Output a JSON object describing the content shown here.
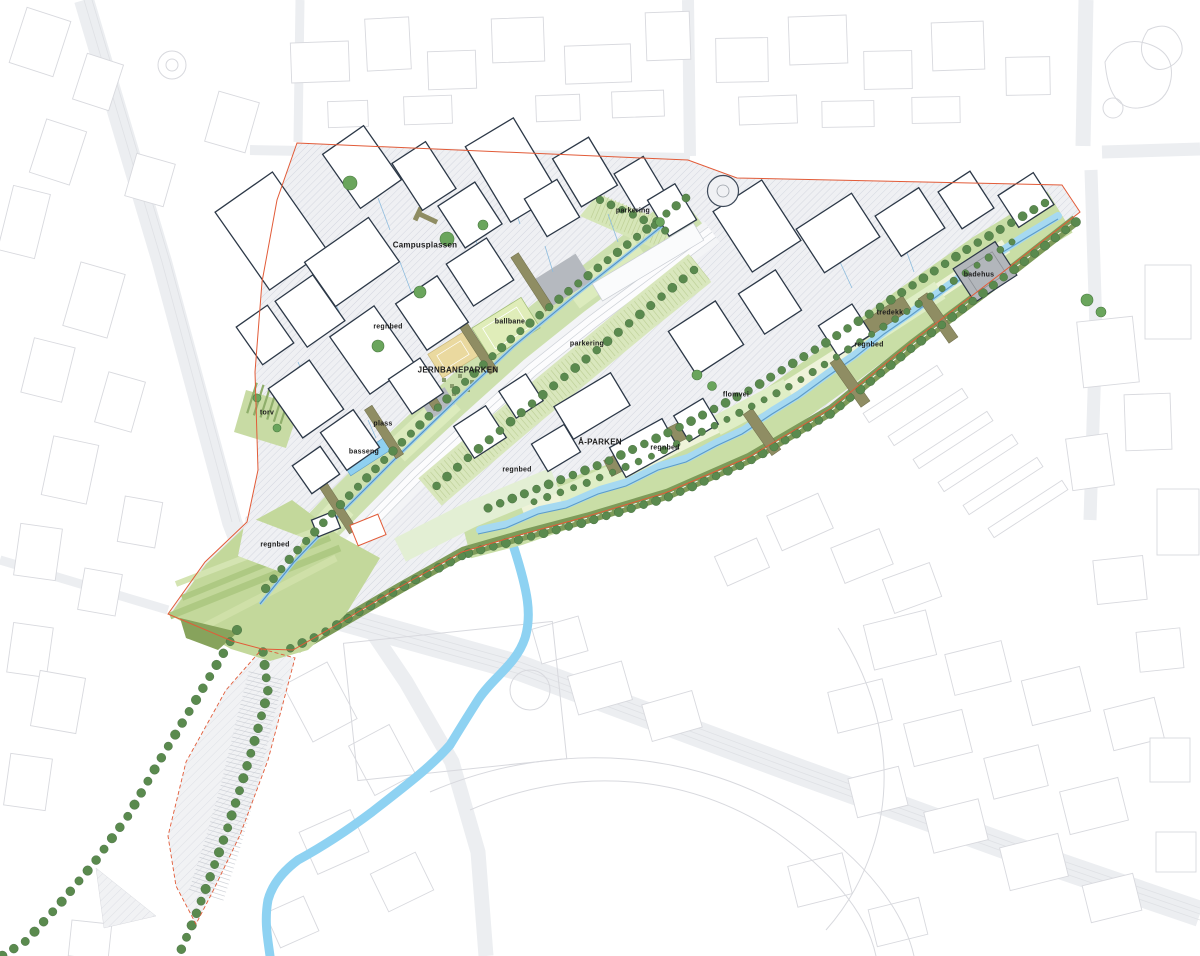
{
  "map": {
    "labels": [
      {
        "text": "Campusplassen",
        "x": 425,
        "y": 245,
        "size": 8
      },
      {
        "text": "parkering",
        "x": 633,
        "y": 211,
        "size": 7
      },
      {
        "text": "regnbed",
        "x": 388,
        "y": 327,
        "size": 7
      },
      {
        "text": "ballbane",
        "x": 510,
        "y": 322,
        "size": 7
      },
      {
        "text": "JERNBANEPARKEN",
        "x": 458,
        "y": 370,
        "size": 8
      },
      {
        "text": "parkering",
        "x": 587,
        "y": 344,
        "size": 7
      },
      {
        "text": "torv",
        "x": 267,
        "y": 413,
        "size": 7
      },
      {
        "text": "plass",
        "x": 383,
        "y": 424,
        "size": 7
      },
      {
        "text": "basseng",
        "x": 364,
        "y": 452,
        "size": 7
      },
      {
        "text": "Å-PARKEN",
        "x": 600,
        "y": 442,
        "size": 8
      },
      {
        "text": "regnbed",
        "x": 665,
        "y": 448,
        "size": 7
      },
      {
        "text": "flomvei",
        "x": 736,
        "y": 395,
        "size": 7
      },
      {
        "text": "tredekk",
        "x": 890,
        "y": 313,
        "size": 7
      },
      {
        "text": "regnbed",
        "x": 869,
        "y": 345,
        "size": 7
      },
      {
        "text": "badehus",
        "x": 979,
        "y": 275,
        "size": 7
      },
      {
        "text": "regnbed",
        "x": 517,
        "y": 470,
        "size": 7
      },
      {
        "text": "regnbed",
        "x": 275,
        "y": 545,
        "size": 7
      }
    ]
  },
  "palette": {
    "boundary_red": "#e25b38",
    "park_green": "#cde0ae",
    "lawn_light": "#dcebbd",
    "bank_olive": "#7d9b59",
    "stream_blue": "#a6d9f1",
    "river_blue": "#8ed2f2",
    "tree_green": "#5a8a4e",
    "deck_brown": "#8f8d63",
    "court_tan": "#ead99f",
    "surface_gray": "#b5b9bf",
    "building_outline": "#2c3847",
    "context_line": "#d8d9de",
    "label_ink": "#1b1b1b"
  }
}
